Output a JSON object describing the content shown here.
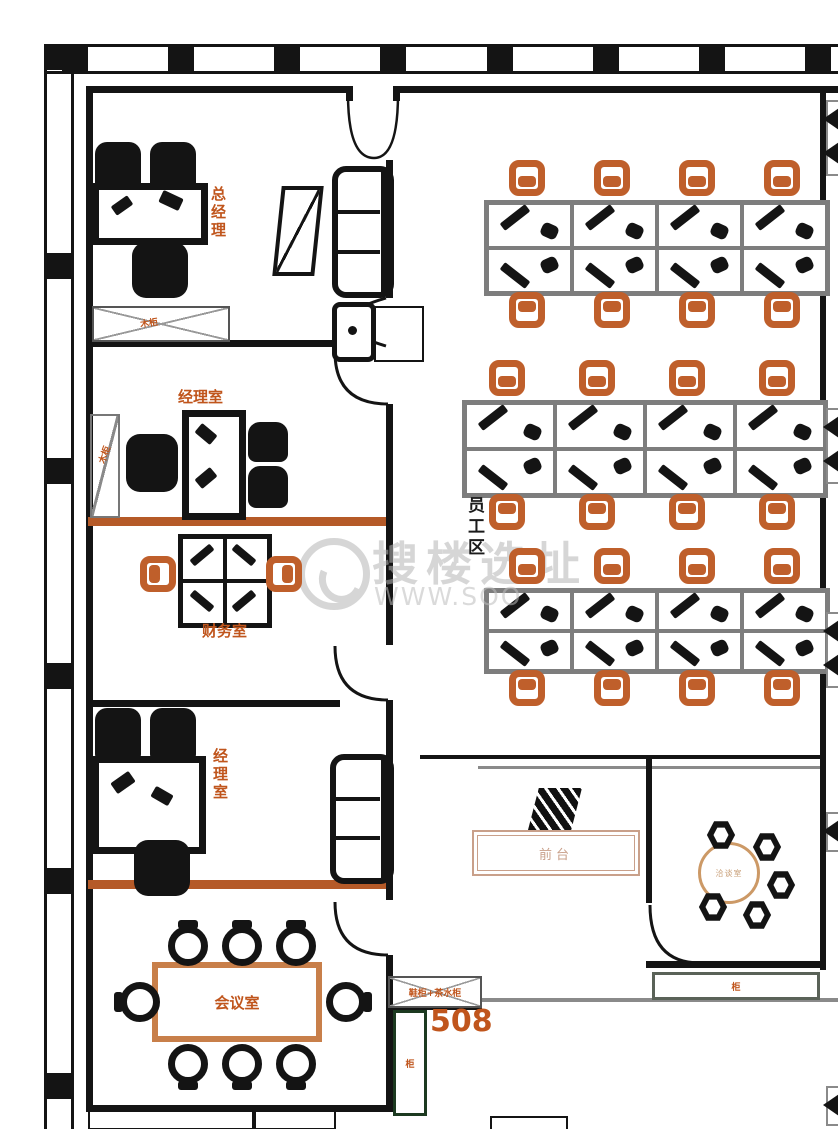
{
  "unit_number": "508",
  "watermark": {
    "brand": "搜楼选址",
    "url": "WWW.SOO"
  },
  "labels": {
    "gm_office": "总经理",
    "manager_office_1": "经理室",
    "finance_office": "财务室",
    "manager_office_2": "经理室",
    "meeting_room": "会议室",
    "staff_area": "员工区",
    "reception_desk": "前台",
    "negotiation_room": "洽谈室",
    "entry_cabinet": "鞋柜+茶水柜",
    "gm_cabinet": "木柜",
    "side_cabinet": "木柜",
    "door_cabinet": "柜",
    "right_cabinet": "柜"
  },
  "colors": {
    "wall": "#141414",
    "accent_orange": "#bf5f2b",
    "label_orange": "#c0551c",
    "desk_grid_gray": "#7d7d7d",
    "divider_orange": "#b55a28",
    "meeting_table_border": "#c87f4a",
    "reception_tone": "#c9a08a",
    "door_green": "#1c3a20",
    "watermark_gray": "#b5b5b5"
  },
  "workstations": {
    "banks": [
      {
        "cols": 4,
        "rows": 2,
        "chairs_top": 4,
        "chairs_bottom": 4
      },
      {
        "cols": 4,
        "rows": 2,
        "chairs_top": 4,
        "chairs_bottom": 4
      },
      {
        "cols": 4,
        "rows": 2,
        "chairs_top": 4,
        "chairs_bottom": 4
      }
    ]
  },
  "conference": {
    "chairs_top": 3,
    "chairs_bottom": 3,
    "chairs_left": 1,
    "chairs_right": 1
  },
  "negotiation": {
    "chair_count": 5
  },
  "finance_cluster": {
    "seats": 4,
    "side_chairs": 2
  }
}
